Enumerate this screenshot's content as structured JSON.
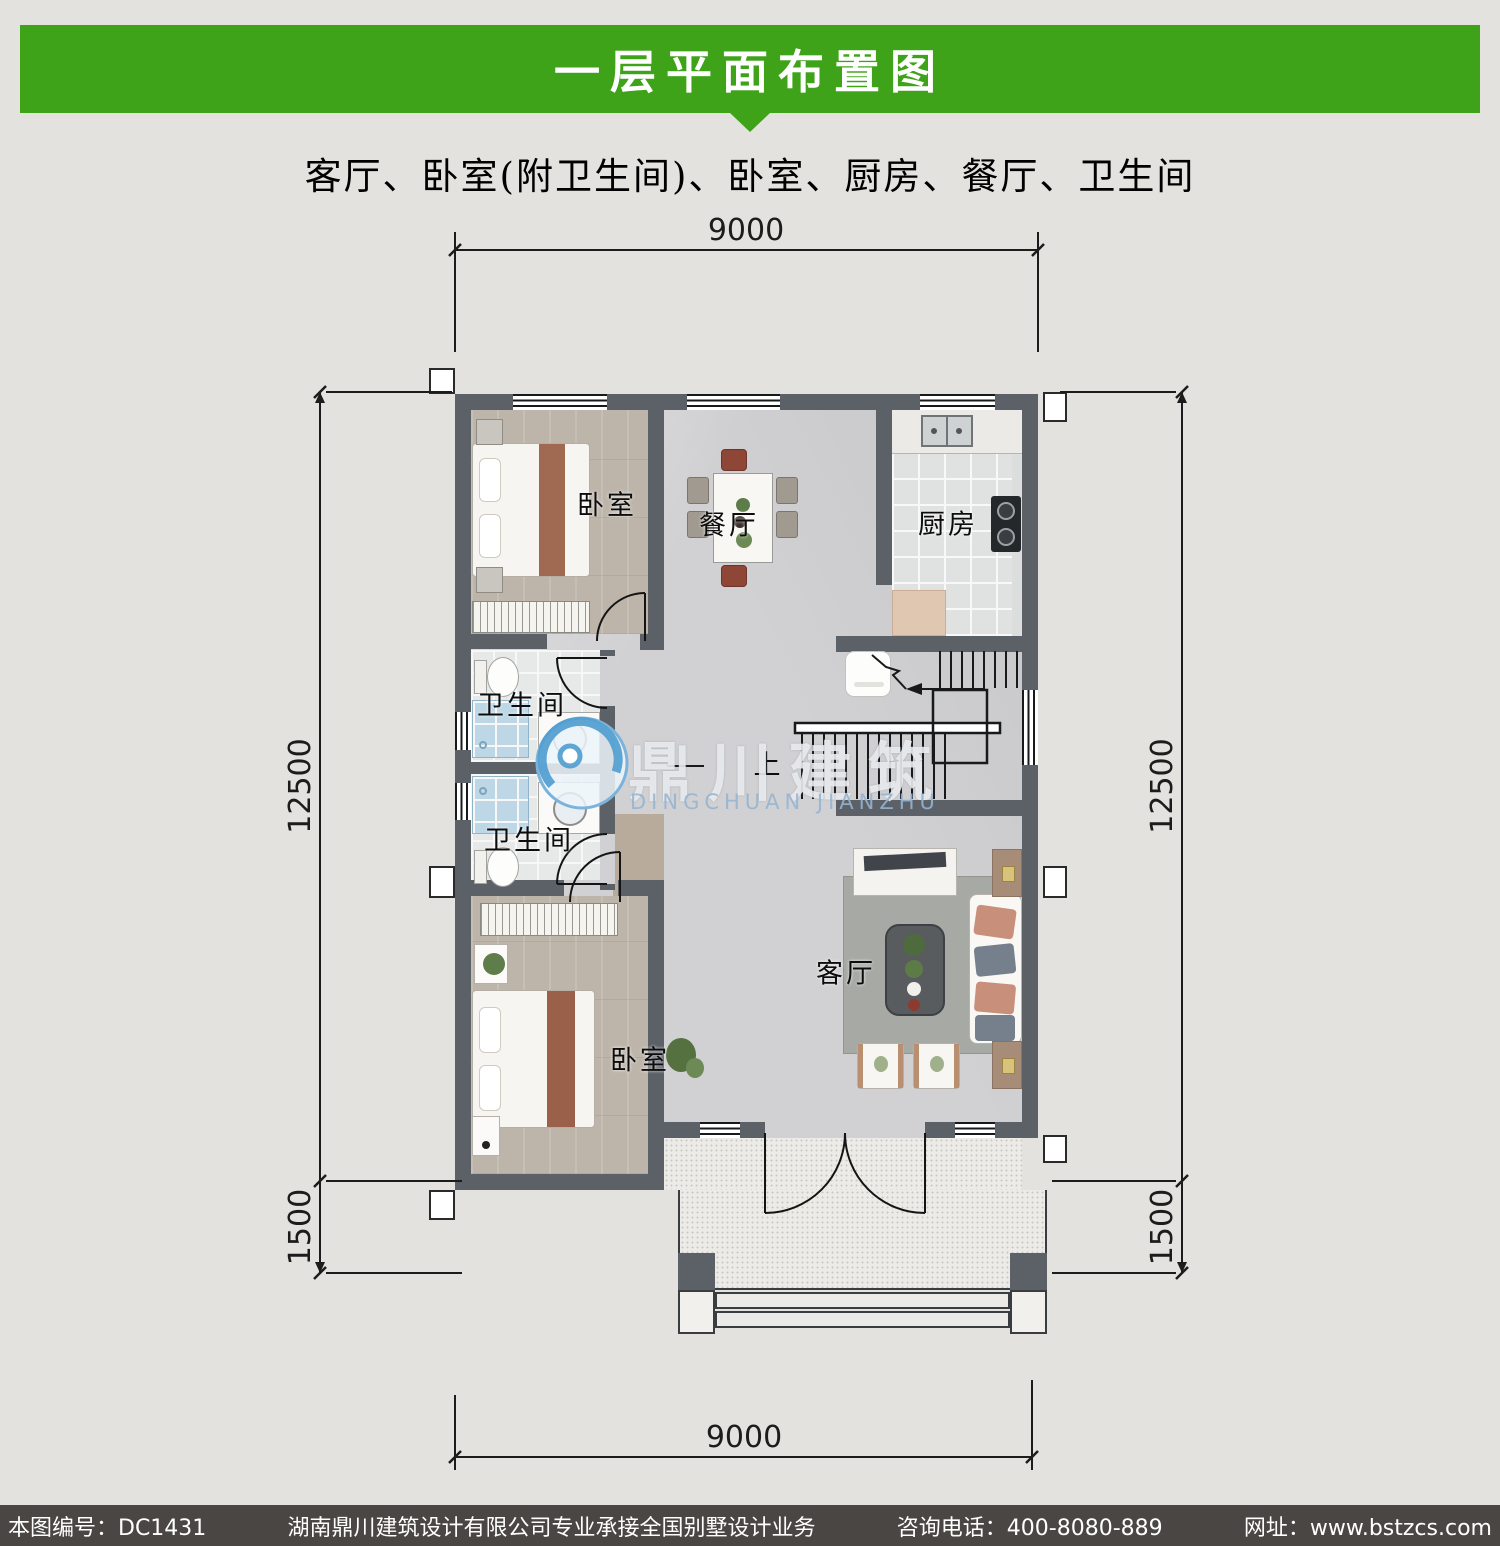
{
  "header": {
    "title": "一层平面布置图",
    "subtitle": "客厅、卧室(附卫生间)、卧室、厨房、餐厅、卫生间"
  },
  "plan": {
    "rooms": [
      {
        "id": "bedroom-top",
        "label": "卧室"
      },
      {
        "id": "dining",
        "label": "餐厅"
      },
      {
        "id": "kitchen",
        "label": "厨房"
      },
      {
        "id": "bath-upper",
        "label": "卫生间"
      },
      {
        "id": "bath-lower",
        "label": "卫生间"
      },
      {
        "id": "living",
        "label": "客厅"
      },
      {
        "id": "bedroom-bottom",
        "label": "卧室"
      }
    ],
    "stairs": {
      "up_label": "上"
    },
    "dimensions": {
      "top": "9000",
      "bottom": "9000",
      "left_main": "12500",
      "left_porch": "1500",
      "right_main": "12500",
      "right_porch": "1500"
    }
  },
  "watermark": {
    "name_cn": "鼎川建筑",
    "name_en": "DINGCHUAN JIANZHU"
  },
  "footer": {
    "plan_no": "本图编号：DC1431",
    "company": "湖南鼎川建筑设计有限公司专业承接全国别墅设计业务",
    "phone": "咨询电话：400-8080-889",
    "website": "网址：www.bstzcs.com"
  },
  "colors": {
    "banner_green": "#3fa31a",
    "wall": "#5c6067",
    "footer_bg": "#494643",
    "watermark_blue": "#4e9ccf",
    "dimension_ink": "#1c1c1c"
  }
}
